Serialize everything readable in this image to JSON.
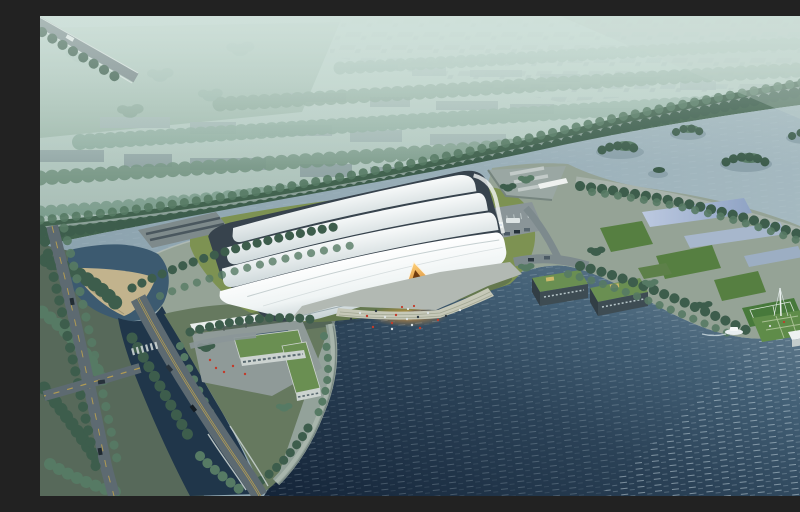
{
  "scene": {
    "description": "Aerial architectural rendering of a lakeside sports venue: a large white curved shell-roofed hall with a glowing amber entrance on a waterfront plaza, pond and channel with bridge roads at lower left, an L-shaped green-roofed service building, a tree-lined peninsula with green-roofed eco buildings, reflecting pools, a lawn sports court, a floating green dock with a small white boat on a deep blue lake, tree islands, a tree-lined levee boulevard and a hazy city skyline beyond.",
    "elements": [
      "hazy-city-skyline",
      "green-fields",
      "tree-rows",
      "levee-boulevard",
      "upper-bay-water",
      "tree-islands",
      "main-venue-building",
      "shell-roof-bands",
      "amber-entrance",
      "entrance-glow",
      "waterfront-plaza",
      "waterfront-steps",
      "visitor-figures",
      "parking-lot",
      "shuttle-buses",
      "service-yard",
      "sandy-beach",
      "pond",
      "channel",
      "bridge-road",
      "left-boulevard",
      "highway-corner",
      "l-shaped-building",
      "entry-canopy",
      "stepped-seawall",
      "eco-buildings",
      "green-roofs",
      "reflecting-pools",
      "promenade-trees",
      "lawn-panels",
      "sports-court",
      "floating-dock",
      "dock-pavilion",
      "mast",
      "motor-boat",
      "big-lake",
      "lake-ripples"
    ]
  },
  "colors": {
    "haze": "#c9dbd4",
    "city": "#8a9ca0",
    "treeDark": "#3d5d4c",
    "treeMid": "#567a64",
    "treeHaze": "#6e9180",
    "field": "#8aa695",
    "levee": "#42634f",
    "bay": "#9aafb9",
    "lakeDeep": "#152539",
    "lakeMid": "#41607a",
    "lakeLight": "#7e95a3",
    "pond": "#3c5a70",
    "channel": "#20364a",
    "campus": "#95a396",
    "landDark": "#57695a",
    "lawn": "#7d9252",
    "lawnDark": "#567f41",
    "shell": "#f4f7f6",
    "shellShade": "#c6d1d4",
    "glazing": "#37434d",
    "plaza": "#b2b9b3",
    "steps": "#c6c8b8",
    "road": "#5d6a71",
    "roadLight": "#7d8a8d",
    "laneYellow": "#c7a84c",
    "sand": "#c9b88e",
    "amber": "#f2a23c",
    "glow": "#ffb84f",
    "ecoRoof": "#6a8f52",
    "ecoWall": "#3e4c53",
    "pool": "#aebdd6",
    "court": "#47793b",
    "dock": "#5f8c49",
    "boat": "#e8eef0",
    "seawall": "#93a29a",
    "figure": "#c23b2a",
    "busBlue": "#3b6ea5"
  }
}
